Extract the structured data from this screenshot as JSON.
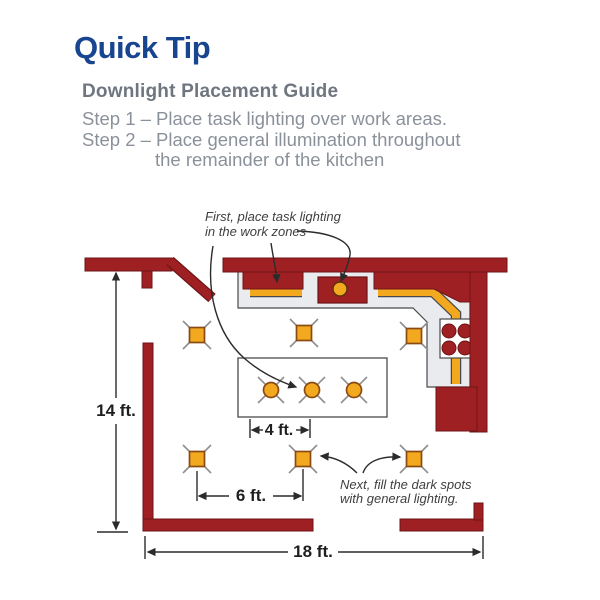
{
  "title": "Quick Tip",
  "subtitle": "Downlight Placement Guide",
  "steps": [
    "Step 1 – Place task lighting over work areas.",
    "Step 2 – Place general illumination throughout",
    "the remainder of the kitchen"
  ],
  "diagram": {
    "task_note": {
      "line1": "First, place task lighting",
      "line2": "in the work zones"
    },
    "general_note": {
      "line1": "Next, fill the dark spots",
      "line2": "with general lighting."
    },
    "dims": {
      "height": "14 ft.",
      "island": "4 ft.",
      "spacing": "6 ft.",
      "width": "18 ft."
    },
    "icons": {
      "recessed_light": "square-downlight-icon",
      "island_light": "round-downlight-icon",
      "task_light": "under-cabinet-strip-icon",
      "stove": "four-burner-stove-icon"
    },
    "colors": {
      "wall": "#9e2023",
      "light_fill": "#f2a81f",
      "counter": "#e9ebee",
      "title_blue": "#17458f",
      "text_gray": "#8b919a",
      "line": "#2b2b2b"
    }
  }
}
